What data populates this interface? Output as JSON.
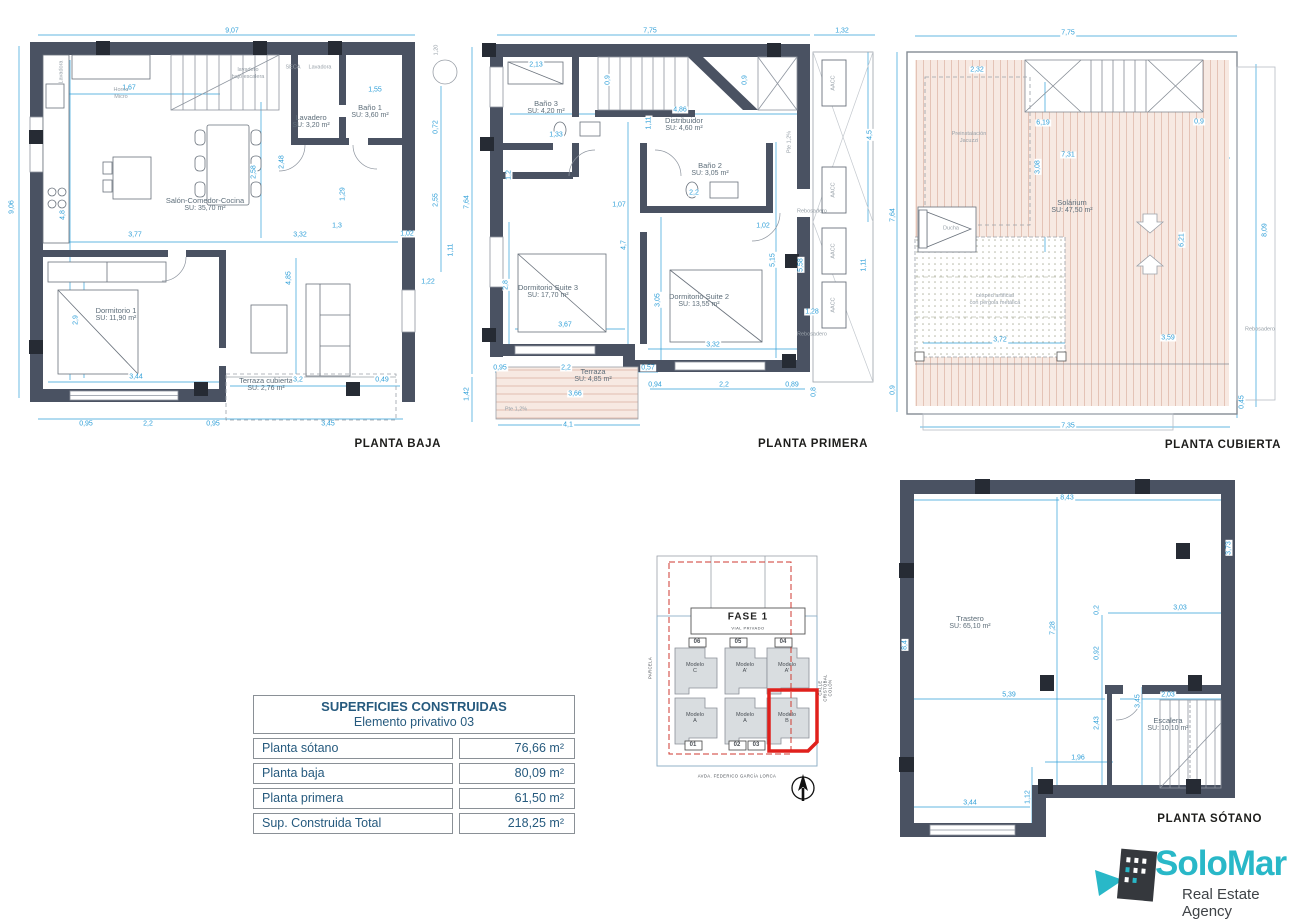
{
  "colors": {
    "wall": "#4a5262",
    "dimension": "#2f9fd8",
    "room_text": "#5d6d79",
    "plan_title": "#1d1d1b",
    "table_text": "#265a7e",
    "roof_fill": "#f7e9e2",
    "highlight_red": "#e0201c",
    "logo_teal": "#29b8c8"
  },
  "plans": {
    "baja": {
      "title": "PLANTA BAJA",
      "rooms": [
        {
          "n": "Salón-Comedor-Cocina",
          "a": "SU: 35,70 m²",
          "x": 197,
          "y": 183
        },
        {
          "n": "Lavadero",
          "a": "SU: 3,20 m²",
          "x": 303,
          "y": 100
        },
        {
          "n": "Baño 1",
          "a": "SU: 3,60 m²",
          "x": 362,
          "y": 90
        },
        {
          "n": "Dormitorio 1",
          "a": "SU: 11,90 m²",
          "x": 108,
          "y": 293
        },
        {
          "n": "Terraza cubierta",
          "a": "SU: 2,76 m²",
          "x": 258,
          "y": 363
        }
      ],
      "dims": [
        {
          "t": "9,07",
          "x": 224,
          "y": 9
        },
        {
          "t": "9,06",
          "x": 4,
          "y": 185,
          "r": -90
        },
        {
          "t": "1,67",
          "x": 121,
          "y": 66
        },
        {
          "t": "4,8",
          "x": 55,
          "y": 193,
          "r": -90
        },
        {
          "t": "2,58",
          "x": 246,
          "y": 150,
          "r": -90
        },
        {
          "t": "2,48",
          "x": 274,
          "y": 140,
          "r": -90
        },
        {
          "t": "1,55",
          "x": 367,
          "y": 68
        },
        {
          "t": "0,72",
          "x": 428,
          "y": 105,
          "r": -90
        },
        {
          "t": "2,55",
          "x": 428,
          "y": 178,
          "r": -90
        },
        {
          "t": "3,77",
          "x": 127,
          "y": 213
        },
        {
          "t": "3,32",
          "x": 292,
          "y": 213
        },
        {
          "t": "1,3",
          "x": 329,
          "y": 204
        },
        {
          "t": "1,29",
          "x": 335,
          "y": 172,
          "r": -90
        },
        {
          "t": "4,85",
          "x": 281,
          "y": 256,
          "r": -90
        },
        {
          "t": "2,9",
          "x": 68,
          "y": 298,
          "r": -90
        },
        {
          "t": "3,44",
          "x": 128,
          "y": 355
        },
        {
          "t": "1,02",
          "x": 399,
          "y": 212
        },
        {
          "t": "1,11",
          "x": 443,
          "y": 228,
          "r": -90
        },
        {
          "t": "1,22",
          "x": 420,
          "y": 260
        },
        {
          "t": "3,2",
          "x": 290,
          "y": 358
        },
        {
          "t": "0,49",
          "x": 374,
          "y": 358
        },
        {
          "t": "0,95",
          "x": 78,
          "y": 402
        },
        {
          "t": "2,2",
          "x": 140,
          "y": 402
        },
        {
          "t": "0,95",
          "x": 205,
          "y": 402
        },
        {
          "t": "3,45",
          "x": 320,
          "y": 402
        }
      ],
      "notes": [
        {
          "t": "Horno\nMicro",
          "x": 113,
          "y": 72
        },
        {
          "t": "lavadero\nbajo escalera",
          "x": 240,
          "y": 52
        },
        {
          "t": "SECA",
          "x": 285,
          "y": 46
        },
        {
          "t": "Lavadora",
          "x": 312,
          "y": 46
        },
        {
          "t": "Lavadora",
          "x": 54,
          "y": 50,
          "r": -90
        },
        {
          "t": "1,20",
          "x": 429,
          "y": 28,
          "r": -90
        }
      ]
    },
    "primera": {
      "title": "PLANTA PRIMERA",
      "rooms": [
        {
          "n": "Baño 3",
          "a": "SU: 4,20 m²",
          "x": 86,
          "y": 86
        },
        {
          "n": "Distribuidor",
          "a": "SU: 4,60 m²",
          "x": 224,
          "y": 103
        },
        {
          "n": "Baño 2",
          "a": "SU: 3,05 m²",
          "x": 250,
          "y": 148
        },
        {
          "n": "Dormitorio Suite 3",
          "a": "SU: 17,70 m²",
          "x": 88,
          "y": 270
        },
        {
          "n": "Dormitorio Suite 2",
          "a": "SU: 13,55 m²",
          "x": 239,
          "y": 279
        },
        {
          "n": "Terraza",
          "a": "SU: 4,85 m²",
          "x": 133,
          "y": 354
        }
      ],
      "dims": [
        {
          "t": "7,75",
          "x": 190,
          "y": 9
        },
        {
          "t": "1,32",
          "x": 382,
          "y": 9
        },
        {
          "t": "7,64",
          "x": 7,
          "y": 180,
          "r": -90
        },
        {
          "t": "1,42",
          "x": 7,
          "y": 372,
          "r": -90
        },
        {
          "t": "2,13",
          "x": 76,
          "y": 43
        },
        {
          "t": "0,9",
          "x": 148,
          "y": 58,
          "r": -90
        },
        {
          "t": "0,9",
          "x": 285,
          "y": 58,
          "r": -90
        },
        {
          "t": "4,86",
          "x": 220,
          "y": 88
        },
        {
          "t": "1,11",
          "x": 189,
          "y": 101,
          "r": -90
        },
        {
          "t": "1,33",
          "x": 96,
          "y": 113
        },
        {
          "t": "1,2",
          "x": 49,
          "y": 153,
          "r": -90
        },
        {
          "t": "1,07",
          "x": 159,
          "y": 183
        },
        {
          "t": "2,2",
          "x": 234,
          "y": 171
        },
        {
          "t": "1,02",
          "x": 303,
          "y": 204
        },
        {
          "t": "4,5",
          "x": 410,
          "y": 113,
          "r": -90
        },
        {
          "t": "2,8",
          "x": 46,
          "y": 263,
          "r": -90
        },
        {
          "t": "4,7",
          "x": 164,
          "y": 223,
          "r": -90
        },
        {
          "t": "3,05",
          "x": 198,
          "y": 278,
          "r": -90
        },
        {
          "t": "5,15",
          "x": 313,
          "y": 238,
          "r": -90
        },
        {
          "t": "5,58",
          "x": 341,
          "y": 243,
          "r": -90
        },
        {
          "t": "3,67",
          "x": 105,
          "y": 303
        },
        {
          "t": "3,32",
          "x": 253,
          "y": 323
        },
        {
          "t": "0,95",
          "x": 40,
          "y": 346
        },
        {
          "t": "2,2",
          "x": 106,
          "y": 346
        },
        {
          "t": "0,57",
          "x": 188,
          "y": 346
        },
        {
          "t": "0,94",
          "x": 195,
          "y": 363
        },
        {
          "t": "2,2",
          "x": 264,
          "y": 363
        },
        {
          "t": "0,89",
          "x": 332,
          "y": 363
        },
        {
          "t": "3,66",
          "x": 115,
          "y": 372
        },
        {
          "t": "4,1",
          "x": 108,
          "y": 403
        },
        {
          "t": "0,8",
          "x": 354,
          "y": 370,
          "r": -90
        },
        {
          "t": "1,11",
          "x": 404,
          "y": 243,
          "r": -90
        },
        {
          "t": "1,28",
          "x": 352,
          "y": 290
        }
      ],
      "notes": [
        {
          "t": "AACC",
          "x": 374,
          "y": 61,
          "r": -90
        },
        {
          "t": "AACC",
          "x": 374,
          "y": 168,
          "r": -90
        },
        {
          "t": "AACC",
          "x": 374,
          "y": 229,
          "r": -90
        },
        {
          "t": "AACC",
          "x": 374,
          "y": 283,
          "r": -90
        },
        {
          "t": "Rebosadero",
          "x": 352,
          "y": 190
        },
        {
          "t": "Rebosadero",
          "x": 352,
          "y": 313
        },
        {
          "t": "Pte 1,2%",
          "x": 330,
          "y": 120,
          "r": -90
        },
        {
          "t": "Pte 1,2%",
          "x": 56,
          "y": 388
        }
      ]
    },
    "cubierta": {
      "title": "PLANTA CUBIERTA",
      "rooms": [
        {
          "n": "Solárium",
          "a": "SU: 47,50 m²",
          "x": 187,
          "y": 185
        }
      ],
      "dims": [
        {
          "t": "7,75",
          "x": 183,
          "y": 11
        },
        {
          "t": "2,32",
          "x": 92,
          "y": 48
        },
        {
          "t": "6,19",
          "x": 158,
          "y": 101
        },
        {
          "t": "0,9",
          "x": 314,
          "y": 100
        },
        {
          "t": "7,31",
          "x": 183,
          "y": 133
        },
        {
          "t": "3,08",
          "x": 153,
          "y": 145,
          "r": -90
        },
        {
          "t": "7,64",
          "x": 8,
          "y": 193,
          "r": -90
        },
        {
          "t": "8,09",
          "x": 380,
          "y": 208,
          "r": -90
        },
        {
          "t": "6,21",
          "x": 297,
          "y": 218,
          "r": -90
        },
        {
          "t": "3,72",
          "x": 115,
          "y": 318
        },
        {
          "t": "3,59",
          "x": 283,
          "y": 316
        },
        {
          "t": "0,9",
          "x": 8,
          "y": 368,
          "r": -90
        },
        {
          "t": "0,45",
          "x": 357,
          "y": 380,
          "r": -90
        },
        {
          "t": "7,35",
          "x": 183,
          "y": 404
        }
      ],
      "notes": [
        {
          "t": "Preinstalación\nJacuzzi",
          "x": 84,
          "y": 116
        },
        {
          "t": "Ducha",
          "x": 66,
          "y": 207
        },
        {
          "t": "césped artificial\ncon pérgola metálica",
          "x": 110,
          "y": 278
        },
        {
          "t": "Rebosadero",
          "x": 375,
          "y": 308
        }
      ]
    },
    "sotano": {
      "title": "PLANTA SÓTANO",
      "rooms": [
        {
          "n": "Trastero",
          "a": "SU: 65,10 m²",
          "x": 90,
          "y": 168
        },
        {
          "n": "Escalera",
          "a": "SU: 10,10 m²",
          "x": 288,
          "y": 270
        }
      ],
      "dims": [
        {
          "t": "8,43",
          "x": 187,
          "y": 43
        },
        {
          "t": "3,73",
          "x": 349,
          "y": 93,
          "r": -90
        },
        {
          "t": "8,4",
          "x": 25,
          "y": 190,
          "r": -90
        },
        {
          "t": "7,28",
          "x": 173,
          "y": 173,
          "r": -90
        },
        {
          "t": "0,2",
          "x": 217,
          "y": 155,
          "r": -90
        },
        {
          "t": "3,03",
          "x": 300,
          "y": 153
        },
        {
          "t": "0,92",
          "x": 217,
          "y": 198,
          "r": -90
        },
        {
          "t": "5,39",
          "x": 129,
          "y": 240
        },
        {
          "t": "2,03",
          "x": 288,
          "y": 240
        },
        {
          "t": "3,45",
          "x": 258,
          "y": 246,
          "r": -90
        },
        {
          "t": "2,43",
          "x": 217,
          "y": 268,
          "r": -90
        },
        {
          "t": "1,96",
          "x": 198,
          "y": 303
        },
        {
          "t": "1,12",
          "x": 148,
          "y": 342,
          "r": -90
        },
        {
          "t": "3,44",
          "x": 90,
          "y": 348
        }
      ],
      "notes": []
    }
  },
  "site": {
    "fase": "FASE 1",
    "vial": "VIAL PRIVADO",
    "street_left": "PARCELA",
    "street_right": "CALLE CRISTÓBAL COLÓN",
    "street_bottom": "AVDA. FEDERICO GARCÍA LORCA",
    "plots_top": [
      "06",
      "05",
      "04"
    ],
    "plots_bottom": [
      "01",
      "02",
      "03"
    ],
    "models_top": [
      "Modelo\nC",
      "Modelo\nA'",
      "Modelo\nA'"
    ],
    "models_bottom": [
      "Modelo\nA",
      "Modelo\nA",
      "Modelo\nB"
    ]
  },
  "table": {
    "title": "SUPERFICIES CONSTRUIDAS",
    "subtitle": "Elemento privativo 03",
    "rows": [
      {
        "label": "Planta sótano",
        "value": "76,66 m²"
      },
      {
        "label": "Planta baja",
        "value": "80,09 m²"
      },
      {
        "label": "Planta primera",
        "value": "61,50 m²"
      },
      {
        "label": "Sup. Construida Total",
        "value": "218,25 m²"
      }
    ]
  },
  "logo": {
    "name": "SoloMar",
    "tagline": "Real Estate Agency"
  }
}
